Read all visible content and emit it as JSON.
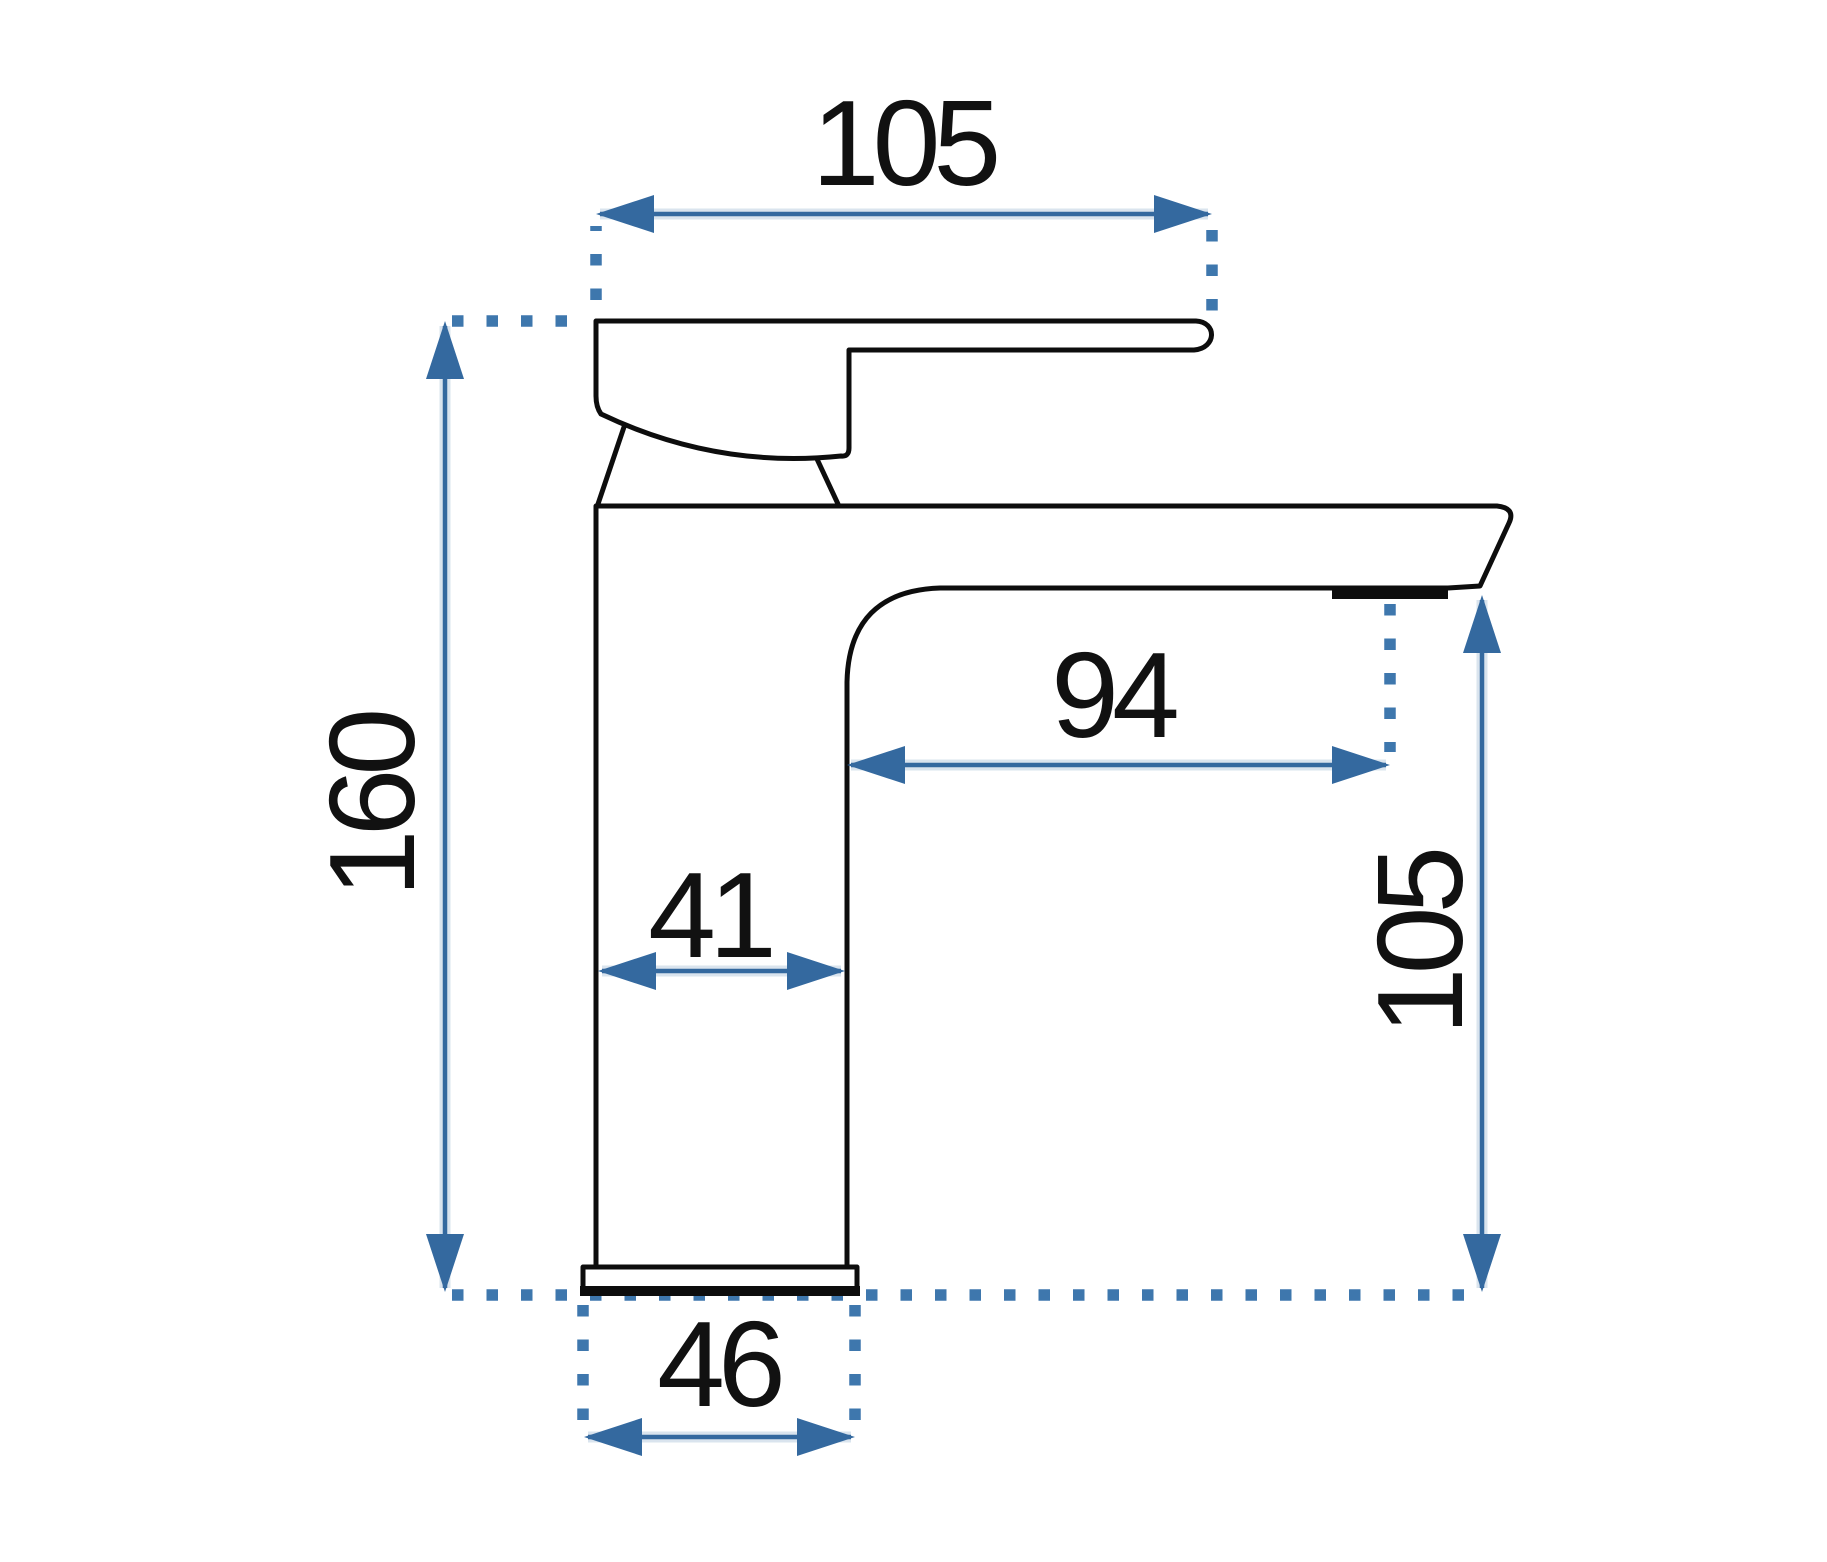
{
  "drawing": {
    "kind": "faucet-dimension-diagram",
    "dimensions": {
      "top_width": "105",
      "total_height": "160",
      "spout_reach": "94",
      "body_width": "41",
      "spout_height": "105",
      "base_width": "46"
    },
    "colors": {
      "dimension_blue": "#34699f",
      "dotted_blue": "#3e77ad",
      "outline_black": "#0d0d0d",
      "text_black": "#111111",
      "background": "#ffffff"
    }
  }
}
